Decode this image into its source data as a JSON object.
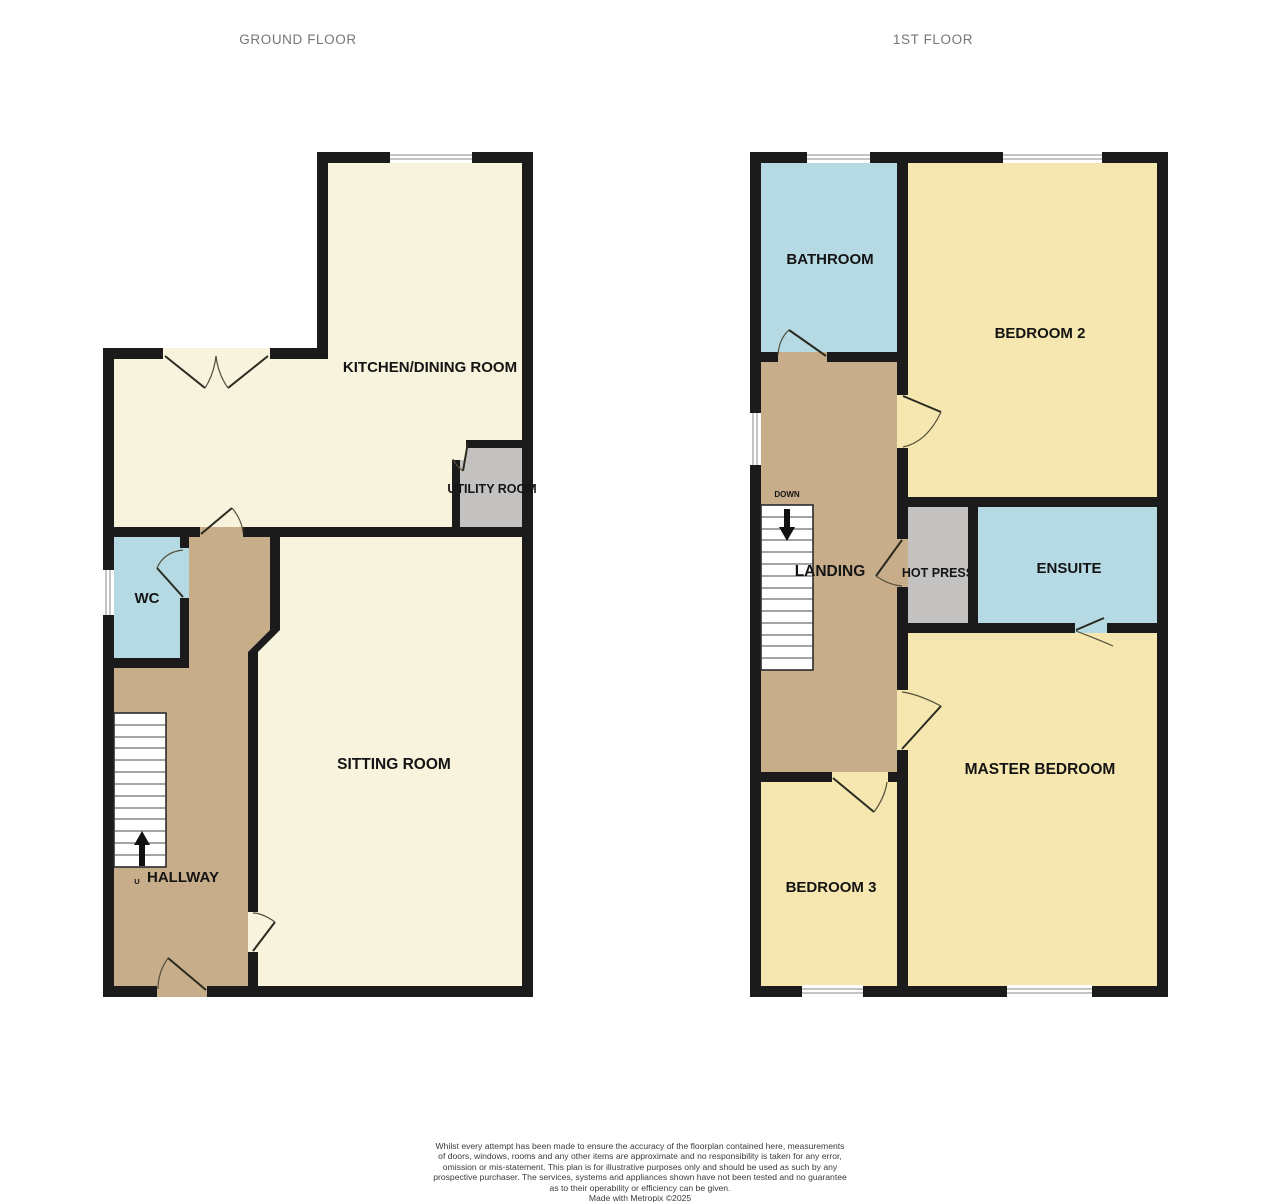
{
  "colors": {
    "wall": "#1b1b1b",
    "cream": "#f7f3dc",
    "yellow": "#f5e7af",
    "blue": "#b5dae3",
    "tan": "#c8ad8a",
    "gray": "#c3c2c0"
  },
  "ground": {
    "title": "GROUND FLOOR",
    "rooms": {
      "kitchen": "KITCHEN/DINING ROOM",
      "utility": "UTILITY ROOM",
      "wc": "WC",
      "sitting": "SITTING ROOM",
      "hallway": "HALLWAY",
      "stairs_direction": "U"
    }
  },
  "first": {
    "title": "1ST FLOOR",
    "rooms": {
      "bathroom": "BATHROOM",
      "bedroom2": "BEDROOM 2",
      "landing": "LANDING",
      "hotpress": "HOT PRESS",
      "ensuite": "ENSUITE",
      "master": "MASTER BEDROOM",
      "bedroom3": "BEDROOM 3",
      "stairs_direction": "DOWN"
    }
  },
  "disclaimer": {
    "lines": [
      "Whilst every attempt has been made to ensure the accuracy of the floorplan contained here, measurements",
      "of doors, windows, rooms and any other items are approximate and no responsibility is taken for any error,",
      "omission or mis-statement. This plan is for illustrative purposes only and should be used as such by any",
      "prospective purchaser. The services, systems and appliances shown have not been tested and no guarantee",
      "as to their operability or efficiency can be given.",
      "Made with Metropix ©2025"
    ]
  }
}
